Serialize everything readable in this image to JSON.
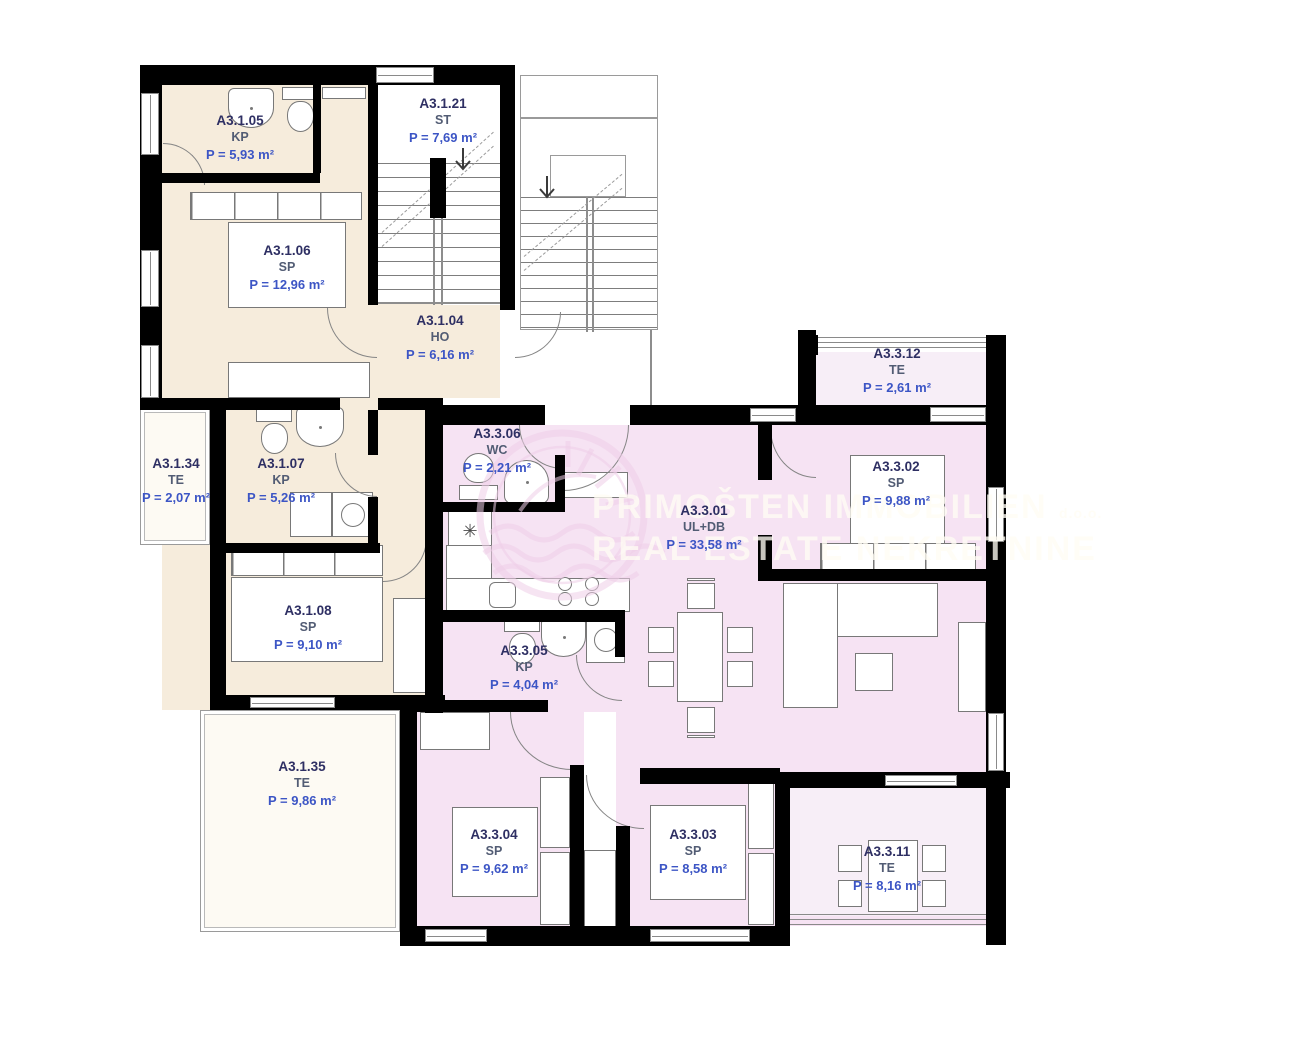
{
  "title": "Floor plan apartments A3.1 / A3.3",
  "watermark": {
    "line1": "PRIMOŠTEN IMMOBILIEN",
    "suffix": "d.o.o.",
    "line2": "REAL ESTATE NEKRETNINE"
  },
  "rooms": [
    {
      "id": "A3.1.05",
      "type": "KP",
      "area": "P = 5,93 m²"
    },
    {
      "id": "A3.1.06",
      "type": "SP",
      "area": "P = 12,96 m²"
    },
    {
      "id": "A3.1.21",
      "type": "ST",
      "area": "P = 7,69 m²"
    },
    {
      "id": "A3.1.04",
      "type": "HO",
      "area": "P = 6,16 m²"
    },
    {
      "id": "A3.1.34",
      "type": "TE",
      "area": "P = 2,07 m²"
    },
    {
      "id": "A3.1.07",
      "type": "KP",
      "area": "P = 5,26 m²"
    },
    {
      "id": "A3.1.08",
      "type": "SP",
      "area": "P = 9,10 m²"
    },
    {
      "id": "A3.1.35",
      "type": "TE",
      "area": "P = 9,86 m²"
    },
    {
      "id": "A3.3.06",
      "type": "WC",
      "area": "P = 2,21 m²"
    },
    {
      "id": "A3.3.01",
      "type": "UL+DB",
      "area": "P = 33,58 m²"
    },
    {
      "id": "A3.3.12",
      "type": "TE",
      "area": "P = 2,61 m²"
    },
    {
      "id": "A3.3.02",
      "type": "SP",
      "area": "P = 9,88 m²"
    },
    {
      "id": "A3.3.05",
      "type": "KP",
      "area": "P = 4,04 m²"
    },
    {
      "id": "A3.3.04",
      "type": "SP",
      "area": "P = 9,62 m²"
    },
    {
      "id": "A3.3.03",
      "type": "SP",
      "area": "P = 8,58 m²"
    },
    {
      "id": "A3.3.11",
      "type": "TE",
      "area": "P = 8,16 m²"
    }
  ],
  "colors": {
    "wall": "#000000",
    "unit_a31_fill": "#f6ecdc",
    "unit_a33_fill": "#f6e3f3",
    "terrace_pink_fill": "#f7eef7",
    "terrace_white_fill": "#fdfaf3",
    "label_code": "#2e2f63",
    "label_type": "#525c74",
    "label_area": "#3c55c5",
    "watermark_text": "rgba(255,252,244,0.78)"
  }
}
